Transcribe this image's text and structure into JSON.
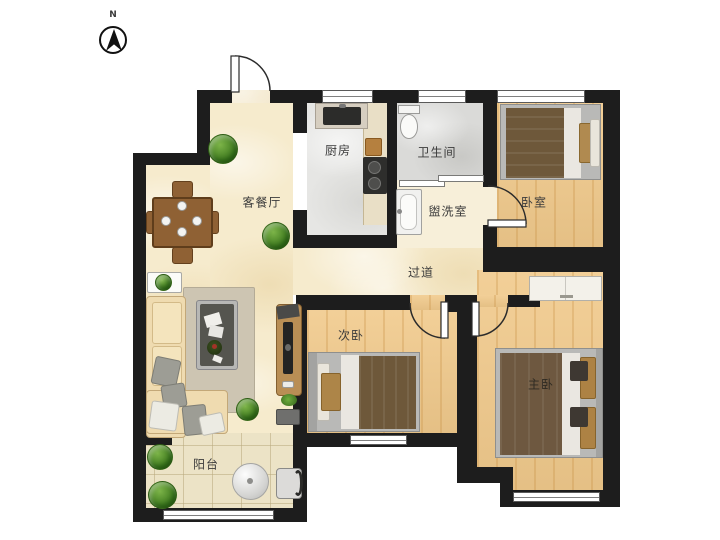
{
  "compass": {
    "north_label": "N"
  },
  "rooms": {
    "living_dining": {
      "label": "客餐厅"
    },
    "kitchen": {
      "label": "厨房"
    },
    "bathroom": {
      "label": "卫生间"
    },
    "bedroom": {
      "label": "卧室"
    },
    "washroom": {
      "label": "盥洗室"
    },
    "corridor": {
      "label": "过道"
    },
    "second_bedroom": {
      "label": "次卧"
    },
    "master_bedroom": {
      "label": "主卧"
    },
    "balcony": {
      "label": "阳台"
    }
  },
  "palette": {
    "wall": "#1d1d1d",
    "floor_marble": "#f6ebcd",
    "floor_wood": "#f1ca8c",
    "floor_kitchen": "#e6e6e4",
    "floor_bathroom": "#dadad8",
    "floor_washroom": "#f7efd9",
    "floor_balcony_tile": "#ece3c6",
    "bed_blanket": "#6e583a",
    "furniture_wood": "#8f6134",
    "plant_green": "#3f7a1f"
  }
}
